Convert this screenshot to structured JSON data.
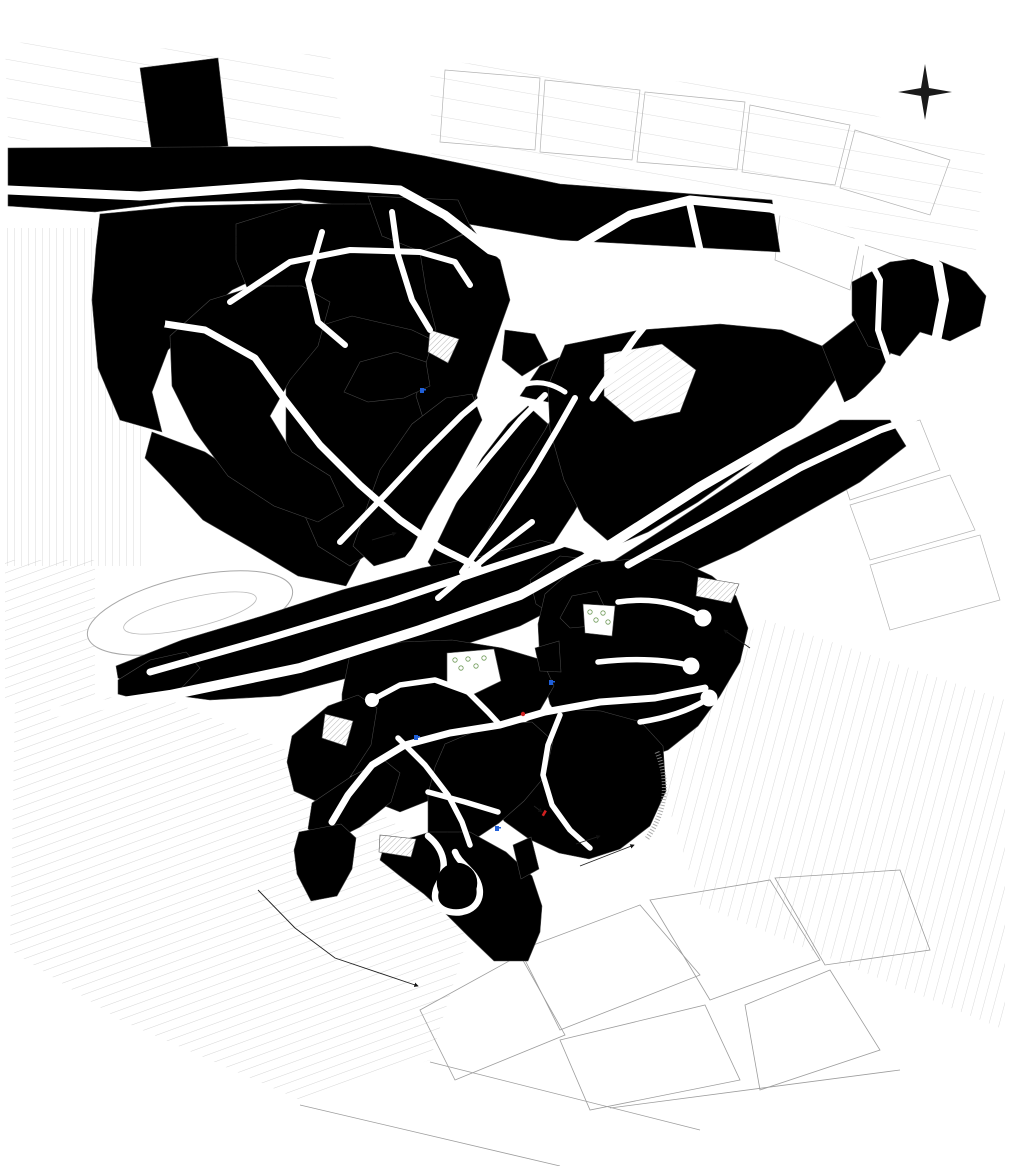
{
  "map": {
    "compass": {
      "top": "E",
      "right": "S",
      "bottom": "O",
      "left": "N"
    },
    "zone_colors": {
      "y1977": "#E2A639",
      "y1979": "#C9E99B",
      "y1989": "#F1DE96",
      "y2003": "#5A10D8",
      "y2004": "#EFC28E",
      "y2005": "#C69070",
      "y2006": "#8193DE",
      "y2007": "#ABF0D2",
      "y2008": "#A5DCF2",
      "y2009": "#F6F297",
      "y2013": "#E59B7E",
      "y2015": "#83A999",
      "y2016": "#F4EF95",
      "y2018": "#DE79E8",
      "y2020": "#E8872F",
      "y2025": "#20809C",
      "rose": "#D88585",
      "ev": "#52AE32",
      "evp": "#7FBE3C",
      "marker_green": "#9BDD2E",
      "sentier_magenta": "#E711C9",
      "sentier_vert": "#2E8B20",
      "stream_blue": "#4A8FE0"
    },
    "labels": [
      {
        "n": "label-year-1977-nw",
        "t": "1977",
        "x": 193,
        "y": 192,
        "r": -76,
        "k": "year",
        "s": 15
      },
      {
        "n": "label-year-1977-e",
        "t": "1977",
        "x": 722,
        "y": 390,
        "r": -62,
        "k": "year",
        "s": 15
      },
      {
        "n": "label-year-1979",
        "t": "1979",
        "x": 763,
        "y": 488,
        "r": -62,
        "k": "year",
        "s": 15
      },
      {
        "n": "label-year-1977-w",
        "t": "1977",
        "x": 142,
        "y": 685,
        "r": -18,
        "k": "year",
        "s": 12
      },
      {
        "n": "label-year-1977-c",
        "t": "1977",
        "x": 555,
        "y": 592,
        "r": -55,
        "k": "year",
        "s": 12
      },
      {
        "n": "label-year-1989",
        "t": "1989",
        "x": 336,
        "y": 617,
        "r": -62,
        "k": "year",
        "s": 15
      },
      {
        "n": "label-year-2009",
        "t": "2009",
        "x": 219,
        "y": 323,
        "r": -75,
        "k": "year",
        "s": 13
      },
      {
        "n": "label-year-2007",
        "t": "2007",
        "x": 279,
        "y": 324,
        "r": -70,
        "k": "year",
        "s": 13
      },
      {
        "n": "label-year-2008",
        "t": "2008",
        "x": 350,
        "y": 338,
        "r": -68,
        "k": "year",
        "s": 13
      },
      {
        "n": "label-year-2006",
        "t": "2006",
        "x": 444,
        "y": 272,
        "r": -60,
        "k": "year",
        "s": 13
      },
      {
        "n": "label-year-2003",
        "t": "2003",
        "x": 477,
        "y": 463,
        "r": -58,
        "k": "year",
        "s": 13
      },
      {
        "n": "label-year-2005",
        "t": "2005",
        "x": 441,
        "y": 487,
        "r": -58,
        "k": "year",
        "s": 11
      },
      {
        "n": "label-year-2004",
        "t": "2004",
        "x": 528,
        "y": 429,
        "r": -58,
        "k": "year",
        "s": 11
      },
      {
        "n": "label-year-2008-s",
        "t": "2008",
        "x": 387,
        "y": 489,
        "r": -60,
        "k": "year",
        "s": 10
      },
      {
        "n": "label-year-2013",
        "t": "2013",
        "x": 633,
        "y": 643,
        "r": -68,
        "k": "year",
        "s": 15
      },
      {
        "n": "label-year-2015",
        "t": "2015",
        "x": 434,
        "y": 680,
        "r": -68,
        "k": "year",
        "s": 13
      },
      {
        "n": "label-year-2016",
        "t": "2016",
        "x": 484,
        "y": 768,
        "r": -62,
        "k": "year",
        "s": 13
      },
      {
        "n": "label-year-2018",
        "t": "2018",
        "x": 519,
        "y": 805,
        "r": -78,
        "k": "year",
        "s": 12
      },
      {
        "n": "label-year-2020",
        "t": "2020",
        "x": 337,
        "y": 783,
        "r": -68,
        "k": "year",
        "s": 15
      },
      {
        "n": "label-year-2025",
        "t": "2025",
        "x": 489,
        "y": 886,
        "r": -80,
        "k": "year",
        "s": 13
      },
      {
        "n": "label-street-1re-avenue",
        "t": "1re AVENUE",
        "x": 275,
        "y": 177,
        "r": -5,
        "k": "street"
      },
      {
        "n": "label-street-1re-avenue-e",
        "t": "1re AVENUE",
        "x": 503,
        "y": 255,
        "r": -32,
        "k": "street"
      },
      {
        "n": "label-street-faucons-n",
        "t": "CHEMIN DES FAUCONS",
        "x": 360,
        "y": 243,
        "r": -10,
        "k": "street"
      },
      {
        "n": "label-street-autours",
        "t": "CHEMIN DES AUTOURS",
        "x": 316,
        "y": 290,
        "r": -78,
        "k": "street"
      },
      {
        "n": "label-street-buses",
        "t": "CHEMIN DES BUSES",
        "x": 402,
        "y": 257,
        "r": -80,
        "k": "street"
      },
      {
        "n": "label-street-balbuzard",
        "t": "CHEMIN DU BALBUZARD",
        "x": 262,
        "y": 366,
        "r": -46,
        "k": "street"
      },
      {
        "n": "label-street-aigles",
        "t": "CHEMIN DES AIGLES",
        "x": 423,
        "y": 458,
        "r": -50,
        "k": "street"
      },
      {
        "n": "label-street-aigles-s",
        "t": "CHEMIN DES AIGLES",
        "x": 347,
        "y": 520,
        "r": -66,
        "k": "street"
      },
      {
        "n": "label-street-harfang",
        "t": "CHEMIN DU HARFANG-DES-NEIGES",
        "x": 470,
        "y": 466,
        "r": -51,
        "k": "street",
        "s": 5.2
      },
      {
        "n": "label-street-faucons-s",
        "t": "CHEMIN DES FAUCONS",
        "x": 524,
        "y": 432,
        "r": -51,
        "k": "street"
      },
      {
        "n": "label-street-epervier",
        "t": "ÉPERVIER",
        "x": 532,
        "y": 386,
        "r": -14,
        "k": "street"
      },
      {
        "n": "label-street-eglise",
        "t": "CHEMIN DE L'ÉGLISE",
        "x": 614,
        "y": 343,
        "r": -52,
        "k": "street"
      },
      {
        "n": "label-street-hibou-e",
        "t": "CHEMIN DU HIBOU",
        "x": 700,
        "y": 458,
        "r": -30,
        "k": "street"
      },
      {
        "n": "label-street-hibou-c",
        "t": "CHEMIN DU HIBOU",
        "x": 520,
        "y": 589,
        "r": -24,
        "k": "street"
      },
      {
        "n": "label-street-hibou-w",
        "t": "CHEMIN DU HIBOU",
        "x": 272,
        "y": 677,
        "r": -12,
        "k": "street"
      },
      {
        "n": "label-street-grands-ducs",
        "t": "CHEMIN DES GRANDS-DUCS",
        "x": 737,
        "y": 491,
        "r": -30,
        "k": "street"
      },
      {
        "n": "label-street-nyctale",
        "t": "CHEMIN DE LA NYCTALE",
        "x": 230,
        "y": 645,
        "r": -16,
        "k": "street"
      },
      {
        "n": "label-street-crecerelle",
        "t": "MONTÉE DE LA CRÉCERELLE",
        "x": 484,
        "y": 550,
        "r": -40,
        "k": "street",
        "s": 5.2
      },
      {
        "n": "label-street-croissant-hibou-n",
        "t": "CROISSANT DU HIBOU",
        "x": 661,
        "y": 610,
        "r": -11,
        "k": "street",
        "s": 5.2
      },
      {
        "n": "label-street-croissant-hibou-s",
        "t": "CROISSANT DU HIBOU",
        "x": 650,
        "y": 661,
        "r": -7,
        "k": "street",
        "s": 5.2
      },
      {
        "n": "label-street-philip-toosey-e",
        "t": "CHEMIN PHILIP-TOOSEY",
        "x": 620,
        "y": 701,
        "r": -8,
        "k": "street"
      },
      {
        "n": "label-street-philip-toosey-w",
        "t": "CHEMIN PHILIP-TOOSEY",
        "x": 378,
        "y": 752,
        "r": -58,
        "k": "street",
        "s": 5.2
      },
      {
        "n": "label-street-maclaren",
        "t": "CHEMIN MACLAREN-DONALD",
        "x": 432,
        "y": 772,
        "r": 56,
        "k": "street",
        "s": 5
      },
      {
        "n": "label-street-strickland",
        "t": "CHEMIN JONAH-STRICKLAND",
        "x": 462,
        "y": 801,
        "r": 16,
        "k": "street",
        "s": 5
      },
      {
        "n": "label-street-armand-lortie",
        "t": "CHEMIN ARMAND-LORTIE",
        "x": 550,
        "y": 776,
        "r": -78,
        "k": "street",
        "s": 5.2
      },
      {
        "n": "label-espace-vert-ne",
        "t": "ESPACE\nVERT",
        "x": 906,
        "y": 316,
        "r": -62,
        "k": "note",
        "s": 7
      },
      {
        "n": "label-espace-vert-c",
        "t": "ESPACE VERT",
        "x": 411,
        "y": 380,
        "r": -75,
        "k": "note"
      },
      {
        "n": "label-espace-vert-2013",
        "t": "ESPACE\nVERT",
        "x": 582,
        "y": 608,
        "r": -70,
        "k": "note"
      },
      {
        "n": "label-espace-vert-2015",
        "t": "ESPACE\nVERT",
        "x": 548,
        "y": 657,
        "r": -60,
        "k": "note"
      },
      {
        "n": "label-espace-vert-s",
        "t": "ESPACE VERT",
        "x": 526,
        "y": 862,
        "r": -78,
        "k": "note"
      },
      {
        "n": "label-espace-vert-projete-sw",
        "t": "ESPACE VERT\nPROJETÉ",
        "x": 312,
        "y": 866,
        "r": -75,
        "k": "note"
      },
      {
        "n": "label-espace-vert-sentier",
        "t": "ESPACE VERT\nSENTIER\nPIÉTONNIER",
        "x": 527,
        "y": 330,
        "r": -62,
        "k": "note"
      },
      {
        "n": "label-espace-vert-sentier-projete",
        "t": "ESPACE VERT\nSENTIER PIÉTONNIER\nPROJETÉ",
        "x": 748,
        "y": 659,
        "r": -75,
        "k": "note"
      },
      {
        "n": "label-sentier-pietonnier-ne",
        "t": "SENTIER\nPIÉTONNIER",
        "x": 729,
        "y": 557,
        "r": -60,
        "k": "note"
      },
      {
        "n": "label-sentier-pietonnier-2013",
        "t": "SENTIER\nPIÉTONNIER",
        "x": 578,
        "y": 652,
        "r": -75,
        "k": "note"
      },
      {
        "n": "label-sentier-pietonnier-2015",
        "t": "SENTIER\nPIÉTONNIER",
        "x": 389,
        "y": 700,
        "r": -72,
        "k": "note"
      },
      {
        "n": "label-sentier-pietonnier-c",
        "t": "SENTIER\nPIÉTONNIER",
        "x": 462,
        "y": 377,
        "r": -72,
        "k": "note"
      },
      {
        "n": "label-bassin-1",
        "t": "BASSIN",
        "x": 446,
        "y": 347,
        "r": -60,
        "k": "note"
      },
      {
        "n": "label-bassin-2",
        "t": "BASSIN",
        "x": 714,
        "y": 590,
        "r": -14,
        "k": "note"
      },
      {
        "n": "label-bassin-3",
        "t": "BASSIN",
        "x": 600,
        "y": 620,
        "r": -75,
        "k": "note"
      },
      {
        "n": "label-bassin-4",
        "t": "BASSIN",
        "x": 473,
        "y": 669,
        "r": -55,
        "k": "note"
      },
      {
        "n": "label-bassin-5",
        "t": "BASSIN",
        "x": 337,
        "y": 729,
        "r": -55,
        "k": "note"
      },
      {
        "n": "label-bassin-6",
        "t": "BASSIN",
        "x": 396,
        "y": 846,
        "r": -12,
        "k": "note"
      },
      {
        "n": "label-puits-1",
        "t": "PUITS",
        "x": 433,
        "y": 396,
        "r": -75,
        "k": "note"
      },
      {
        "n": "label-pc",
        "t": "PC",
        "x": 449,
        "y": 383,
        "r": 0,
        "k": "note",
        "s": 5
      },
      {
        "n": "label-puits-2",
        "t": "PUITS",
        "x": 406,
        "y": 729,
        "r": -75,
        "k": "note"
      },
      {
        "n": "label-pe7",
        "t": "PE-7",
        "x": 419,
        "y": 726,
        "r": -75,
        "k": "note",
        "s": 5
      },
      {
        "n": "label-puits-3",
        "t": "PUITS",
        "x": 543,
        "y": 675,
        "r": -75,
        "k": "note"
      },
      {
        "n": "label-pe4",
        "t": "PE-4",
        "x": 557,
        "y": 677,
        "r": -75,
        "k": "note",
        "s": 5
      },
      {
        "n": "label-puits-projete",
        "t": "PUITS\nPROJETÉ",
        "x": 501,
        "y": 812,
        "r": -75,
        "k": "note"
      },
      {
        "n": "label-pe8",
        "t": "PE-8",
        "x": 515,
        "y": 818,
        "r": -75,
        "k": "note",
        "s": 5
      },
      {
        "n": "label-borne-incendie",
        "t": "BORNE À\nINCENDIE",
        "x": 512,
        "y": 721,
        "r": -75,
        "k": "note"
      },
      {
        "n": "label-reservoir-incendie",
        "t": "RÉSERVOIR\nINCENDIE",
        "x": 531,
        "y": 799,
        "r": -75,
        "k": "note"
      },
      {
        "n": "label-poste-surpression",
        "t": "POSTE\nSURPRESSION\nEAU POTABLE",
        "x": 369,
        "y": 546,
        "r": -72,
        "k": "note"
      },
      {
        "n": "label-fosse-drainage",
        "t": "FOSSÉ DE\nDRAINAGE",
        "x": 576,
        "y": 857,
        "r": -75,
        "k": "note"
      },
      {
        "n": "label-phase-v",
        "t": "PHASE V\nÉTAPE 3 ET +",
        "x": 247,
        "y": 903,
        "r": -62,
        "k": "note"
      }
    ]
  }
}
